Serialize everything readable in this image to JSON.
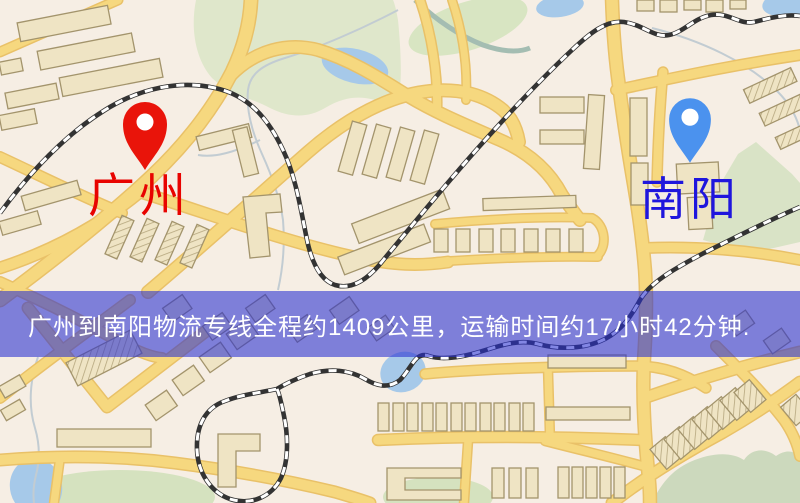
{
  "banner": {
    "text": "广州到南阳物流专线全程约1409公里，运输时间约17小时42分钟.",
    "bg": "rgba(40,46,208,0.58)",
    "text_color": "#ffffff"
  },
  "markers": {
    "origin": {
      "label": "广州",
      "text_color": "#e80300",
      "pin_color": "#e9140a"
    },
    "destination": {
      "label": "南阳",
      "text_color": "#1f16dd",
      "pin_color": "#4b92ee"
    }
  },
  "map_palette": {
    "background": "#f6eee4",
    "road": "#f6d87f",
    "road_edge": "#e9c168",
    "building": "#efe4c4",
    "building_outline": "#a3946c",
    "park_green": "#dde8ca",
    "water_blue": "#a6c9e9",
    "railway_dark": "#333333",
    "railway_light": "#ffffff"
  }
}
